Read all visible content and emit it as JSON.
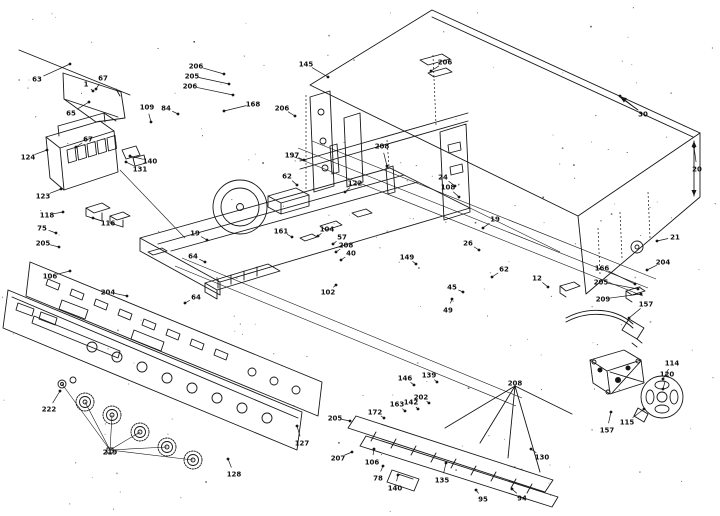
{
  "diagram": {
    "kind": "exploded-parts-diagram",
    "ink_color": "#161616",
    "background_color": "#ffffff",
    "labels": [
      {
        "t": "63",
        "x": 37,
        "y": 79,
        "lx": 70,
        "ly": 64
      },
      {
        "t": "1",
        "x": 86,
        "y": 84,
        "lx": 93,
        "ly": 91
      },
      {
        "t": "67",
        "x": 103,
        "y": 78,
        "lx": 96,
        "ly": 89
      },
      {
        "t": "65",
        "x": 71,
        "y": 113,
        "lx": 89,
        "ly": 102
      },
      {
        "t": "124",
        "x": 28,
        "y": 157,
        "lx": 47,
        "ly": 150
      },
      {
        "t": "67",
        "x": 88,
        "y": 139,
        "lx": 76,
        "ly": 147
      },
      {
        "t": "123",
        "x": 43,
        "y": 196,
        "lx": 61,
        "ly": 189
      },
      {
        "t": "140",
        "x": 150,
        "y": 161,
        "lx": 130,
        "ly": 156
      },
      {
        "t": "131",
        "x": 140,
        "y": 169,
        "lx": 126,
        "ly": 162
      },
      {
        "t": "118",
        "x": 47,
        "y": 215,
        "lx": 63,
        "ly": 212
      },
      {
        "t": "116",
        "x": 108,
        "y": 223,
        "lx": 93,
        "ly": 218
      },
      {
        "t": "75",
        "x": 42,
        "y": 228,
        "lx": 56,
        "ly": 233
      },
      {
        "t": "205",
        "x": 43,
        "y": 243,
        "lx": 59,
        "ly": 247
      },
      {
        "t": "206",
        "x": 196,
        "y": 66,
        "lx": 224,
        "ly": 74
      },
      {
        "t": "205",
        "x": 192,
        "y": 76,
        "lx": 229,
        "ly": 84
      },
      {
        "t": "206",
        "x": 190,
        "y": 86,
        "lx": 233,
        "ly": 95
      },
      {
        "t": "109",
        "x": 147,
        "y": 107,
        "lx": 151,
        "ly": 122
      },
      {
        "t": "84",
        "x": 166,
        "y": 108,
        "lx": 178,
        "ly": 114
      },
      {
        "t": "168",
        "x": 253,
        "y": 104,
        "lx": 224,
        "ly": 111
      },
      {
        "t": "206",
        "x": 282,
        "y": 108,
        "lx": 295,
        "ly": 116
      },
      {
        "t": "197",
        "x": 292,
        "y": 155,
        "lx": 304,
        "ly": 160
      },
      {
        "t": "145",
        "x": 306,
        "y": 64,
        "lx": 328,
        "ly": 77
      },
      {
        "t": "206",
        "x": 445,
        "y": 62,
        "lx": 431,
        "ly": 71
      },
      {
        "t": "208",
        "x": 382,
        "y": 146,
        "lx": 387,
        "ly": 166
      },
      {
        "t": "30",
        "x": 643,
        "y": 114,
        "lx": 620,
        "ly": 96
      },
      {
        "t": "20",
        "x": 697,
        "y": 169,
        "lx": 694,
        "ly": 147
      },
      {
        "t": "21",
        "x": 675,
        "y": 237,
        "lx": 657,
        "ly": 241
      },
      {
        "t": "204",
        "x": 663,
        "y": 262,
        "lx": 647,
        "ly": 270
      },
      {
        "t": "166",
        "x": 602,
        "y": 268,
        "lx": 635,
        "ly": 284
      },
      {
        "t": "205",
        "x": 601,
        "y": 282,
        "lx": 638,
        "ly": 289
      },
      {
        "t": "209",
        "x": 603,
        "y": 299,
        "lx": 641,
        "ly": 294
      },
      {
        "t": "157",
        "x": 646,
        "y": 304,
        "lx": 629,
        "ly": 318
      },
      {
        "t": "114",
        "x": 672,
        "y": 363,
        "lx": 663,
        "ly": 379
      },
      {
        "t": "120",
        "x": 667,
        "y": 374,
        "lx": 663,
        "ly": 389
      },
      {
        "t": "115",
        "x": 627,
        "y": 422,
        "lx": 644,
        "ly": 409
      },
      {
        "t": "157",
        "x": 607,
        "y": 430,
        "lx": 611,
        "ly": 412
      },
      {
        "t": "24",
        "x": 443,
        "y": 177,
        "lx": 455,
        "ly": 186
      },
      {
        "t": "108",
        "x": 448,
        "y": 187,
        "lx": 459,
        "ly": 197
      },
      {
        "t": "19",
        "x": 495,
        "y": 219,
        "lx": 483,
        "ly": 228
      },
      {
        "t": "26",
        "x": 468,
        "y": 243,
        "lx": 479,
        "ly": 250
      },
      {
        "t": "62",
        "x": 504,
        "y": 269,
        "lx": 492,
        "ly": 277
      },
      {
        "t": "45",
        "x": 452,
        "y": 287,
        "lx": 463,
        "ly": 292
      },
      {
        "t": "49",
        "x": 448,
        "y": 310,
        "lx": 452,
        "ly": 299
      },
      {
        "t": "12",
        "x": 537,
        "y": 278,
        "lx": 548,
        "ly": 287
      },
      {
        "t": "62",
        "x": 287,
        "y": 176,
        "lx": 297,
        "ly": 185
      },
      {
        "t": "122",
        "x": 355,
        "y": 183,
        "lx": 345,
        "ly": 192
      },
      {
        "t": "161",
        "x": 281,
        "y": 231,
        "lx": 292,
        "ly": 237
      },
      {
        "t": "104",
        "x": 327,
        "y": 229,
        "lx": 318,
        "ly": 236
      },
      {
        "t": "57",
        "x": 342,
        "y": 237,
        "lx": 333,
        "ly": 244
      },
      {
        "t": "208",
        "x": 346,
        "y": 245,
        "lx": 336,
        "ly": 252
      },
      {
        "t": "40",
        "x": 351,
        "y": 253,
        "lx": 341,
        "ly": 260
      },
      {
        "t": "102",
        "x": 328,
        "y": 292,
        "lx": 336,
        "ly": 285
      },
      {
        "t": "64",
        "x": 193,
        "y": 256,
        "lx": 205,
        "ly": 262
      },
      {
        "t": "19",
        "x": 195,
        "y": 233,
        "lx": 207,
        "ly": 240
      },
      {
        "t": "106",
        "x": 50,
        "y": 276,
        "lx": 70,
        "ly": 271
      },
      {
        "t": "204",
        "x": 108,
        "y": 292,
        "lx": 127,
        "ly": 296
      },
      {
        "t": "64",
        "x": 196,
        "y": 297,
        "lx": 185,
        "ly": 303
      },
      {
        "t": "149",
        "x": 407,
        "y": 257,
        "lx": 416,
        "ly": 264
      },
      {
        "t": "222",
        "x": 49,
        "y": 409,
        "lx": 60,
        "ly": 391
      },
      {
        "t": "219",
        "x": 110,
        "y": 452,
        "lx": null,
        "ly": null
      },
      {
        "t": "128",
        "x": 234,
        "y": 474,
        "lx": 228,
        "ly": 459
      },
      {
        "t": "127",
        "x": 302,
        "y": 443,
        "lx": 297,
        "ly": 426
      },
      {
        "t": "208",
        "x": 515,
        "y": 383,
        "lx": null,
        "ly": null
      },
      {
        "t": "146",
        "x": 405,
        "y": 378,
        "lx": 414,
        "ly": 385
      },
      {
        "t": "139",
        "x": 429,
        "y": 375,
        "lx": 437,
        "ly": 382
      },
      {
        "t": "202",
        "x": 421,
        "y": 397,
        "lx": 429,
        "ly": 403
      },
      {
        "t": "163",
        "x": 397,
        "y": 404,
        "lx": 405,
        "ly": 411
      },
      {
        "t": "142",
        "x": 411,
        "y": 402,
        "lx": 418,
        "ly": 409
      },
      {
        "t": "205",
        "x": 335,
        "y": 418,
        "lx": 350,
        "ly": 421
      },
      {
        "t": "172",
        "x": 375,
        "y": 412,
        "lx": 384,
        "ly": 418
      },
      {
        "t": "207",
        "x": 338,
        "y": 458,
        "lx": 352,
        "ly": 452
      },
      {
        "t": "106",
        "x": 372,
        "y": 462,
        "lx": 374,
        "ly": 449
      },
      {
        "t": "78",
        "x": 378,
        "y": 478,
        "lx": 383,
        "ly": 466
      },
      {
        "t": "140",
        "x": 395,
        "y": 488,
        "lx": 398,
        "ly": 475
      },
      {
        "t": "135",
        "x": 442,
        "y": 480,
        "lx": 446,
        "ly": 463
      },
      {
        "t": "94",
        "x": 522,
        "y": 498,
        "lx": 512,
        "ly": 489
      },
      {
        "t": "95",
        "x": 483,
        "y": 499,
        "lx": 476,
        "ly": 490
      },
      {
        "t": "130",
        "x": 542,
        "y": 457,
        "lx": 531,
        "ly": 449
      }
    ]
  }
}
